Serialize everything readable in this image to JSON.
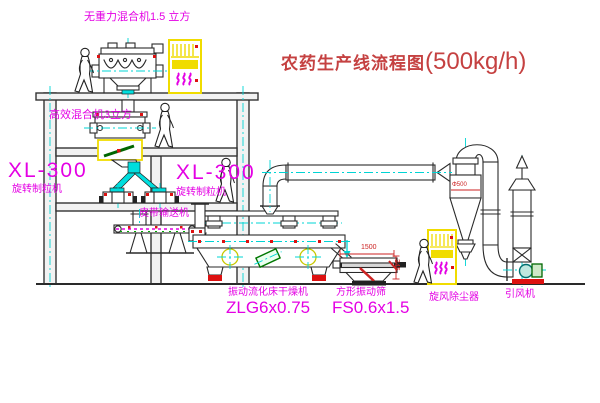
{
  "diagram": {
    "title_zh": "农药生产线流程图",
    "title_capacity": "(500kg/h)"
  },
  "equipment_labels": {
    "gravity_free_mixer": "无重力混合机1.5 立方",
    "high_efficiency_mixer": "高效混合机3立方",
    "granulator_left_model": "XL-300",
    "granulator_left_name": "旋转制粒机",
    "granulator_right_model": "XL-300",
    "granulator_right_name": "旋转制粒机",
    "belt_conveyor": "皮带输送机",
    "dryer_name": "振动流化床干燥机",
    "dryer_model": "ZLG6x0.75",
    "sieve_name": "方形振动筛",
    "sieve_model": "FS0.6x1.5",
    "cyclone_dust_collector": "旋风除尘器",
    "induced_draft_fan": "引风机"
  },
  "dimensions": {
    "sieve_length": "1500",
    "sieve_height": "345",
    "cyclone_diameter": "Φ500"
  },
  "colors": {
    "label_magenta": "#e400e4",
    "title_red": "#c54141",
    "dimension_red": "#cc2222",
    "centerline_cyan": "#00d4d4",
    "cabinet_yellow": "#f0dc00"
  }
}
